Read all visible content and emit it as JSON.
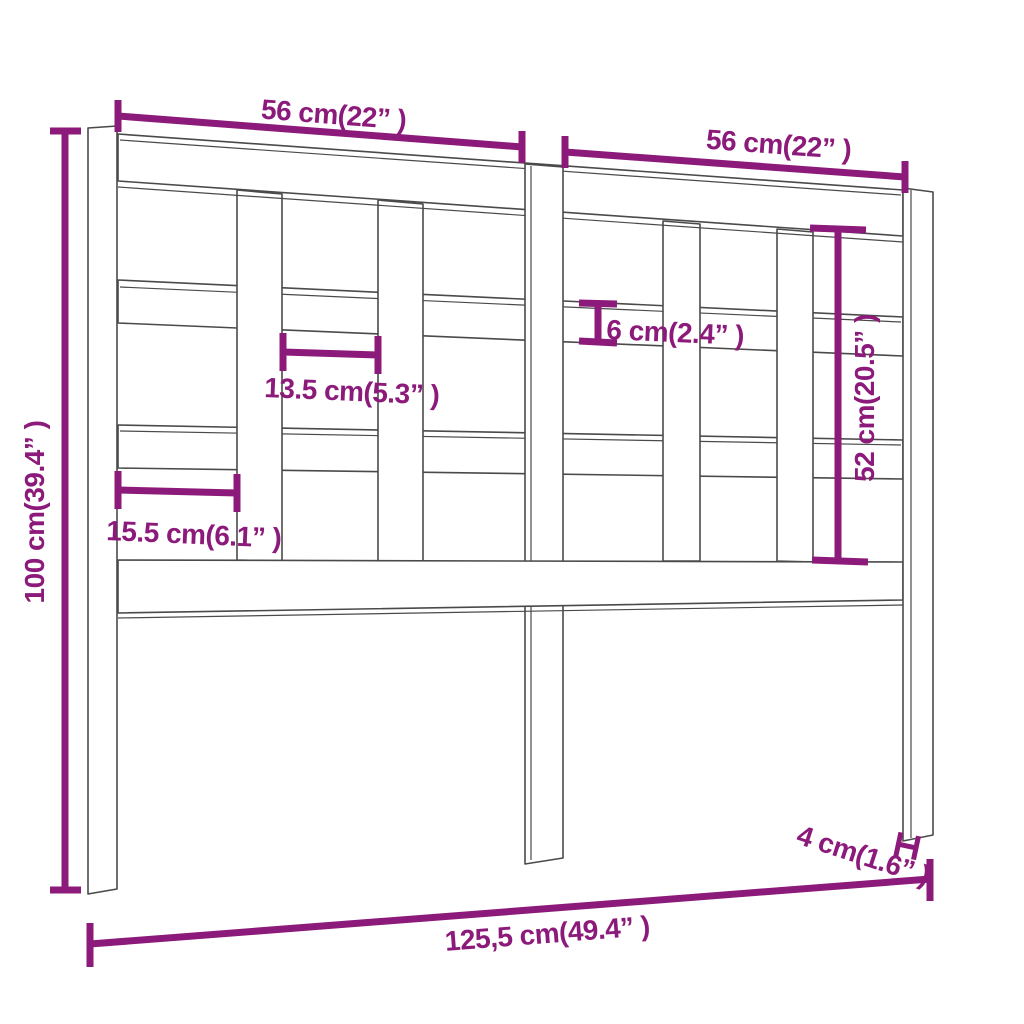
{
  "diagram": {
    "type": "furniture-dimension-drawing",
    "subject": "bed-headboard",
    "accent_color": "#8c1a7a",
    "outline_color": "#4a4a4a",
    "background_color": "#ffffff",
    "labels": {
      "top_left_width": "56 cm(22” )",
      "top_right_width": "56 cm(22” )",
      "total_height": "100 cm(39.4” )",
      "post_to_slat_gap": "15.5 cm(6.1” )",
      "slat_to_slat_gap": "13.5 cm(5.3” )",
      "rail_thickness": "6 cm(2.4” )",
      "panel_height": "52 cm(20.5” )",
      "leg_thickness": "4 cm(1.6” )",
      "total_width": "125,5 cm(49.4” )"
    }
  }
}
